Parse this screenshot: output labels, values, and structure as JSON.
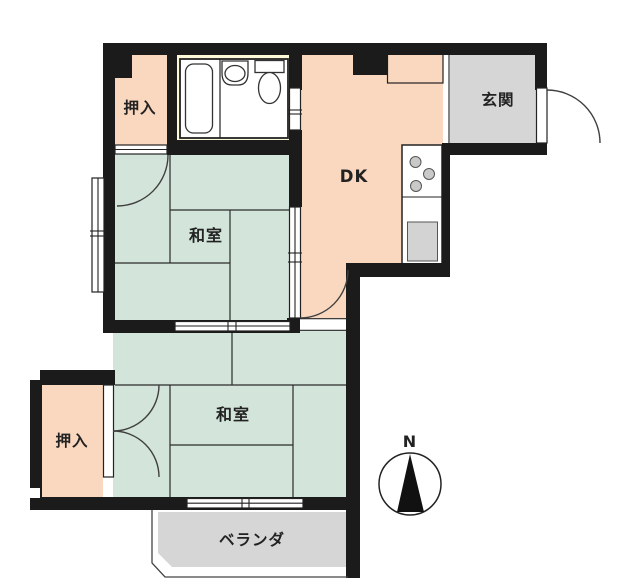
{
  "floor_plan": {
    "type": "japanese-apartment-madori",
    "rooms": {
      "closet_top": {
        "label": "押入"
      },
      "bathroom": {
        "fixtures": [
          "bathtub",
          "sink",
          "toilet"
        ]
      },
      "dk": {
        "label": "DK",
        "fixtures": [
          "stove-burners",
          "kitchen-sink",
          "entrance-cabinet"
        ]
      },
      "entrance": {
        "label": "玄関"
      },
      "washitsu_middle": {
        "label": "和室",
        "tatami_count": 4.5
      },
      "washitsu_bottom": {
        "label": "和室",
        "tatami_count": 6
      },
      "closet_bottom": {
        "label": "押入"
      },
      "veranda": {
        "label": "ベランダ"
      }
    },
    "compass": {
      "label": "N",
      "direction": "up"
    },
    "colors": {
      "wall": "#1b1b1b",
      "line": "#2b2b2b",
      "tatami_green": "#d3e5da",
      "peach": "#fad8bf",
      "bathroom_cream": "#fdf8d7",
      "bathtub_blue": "#d8eaf7",
      "gray_area": "#d6d6d6",
      "fixture_gray": "#c9c9c9",
      "sink_gray": "#d3d3d3"
    }
  }
}
